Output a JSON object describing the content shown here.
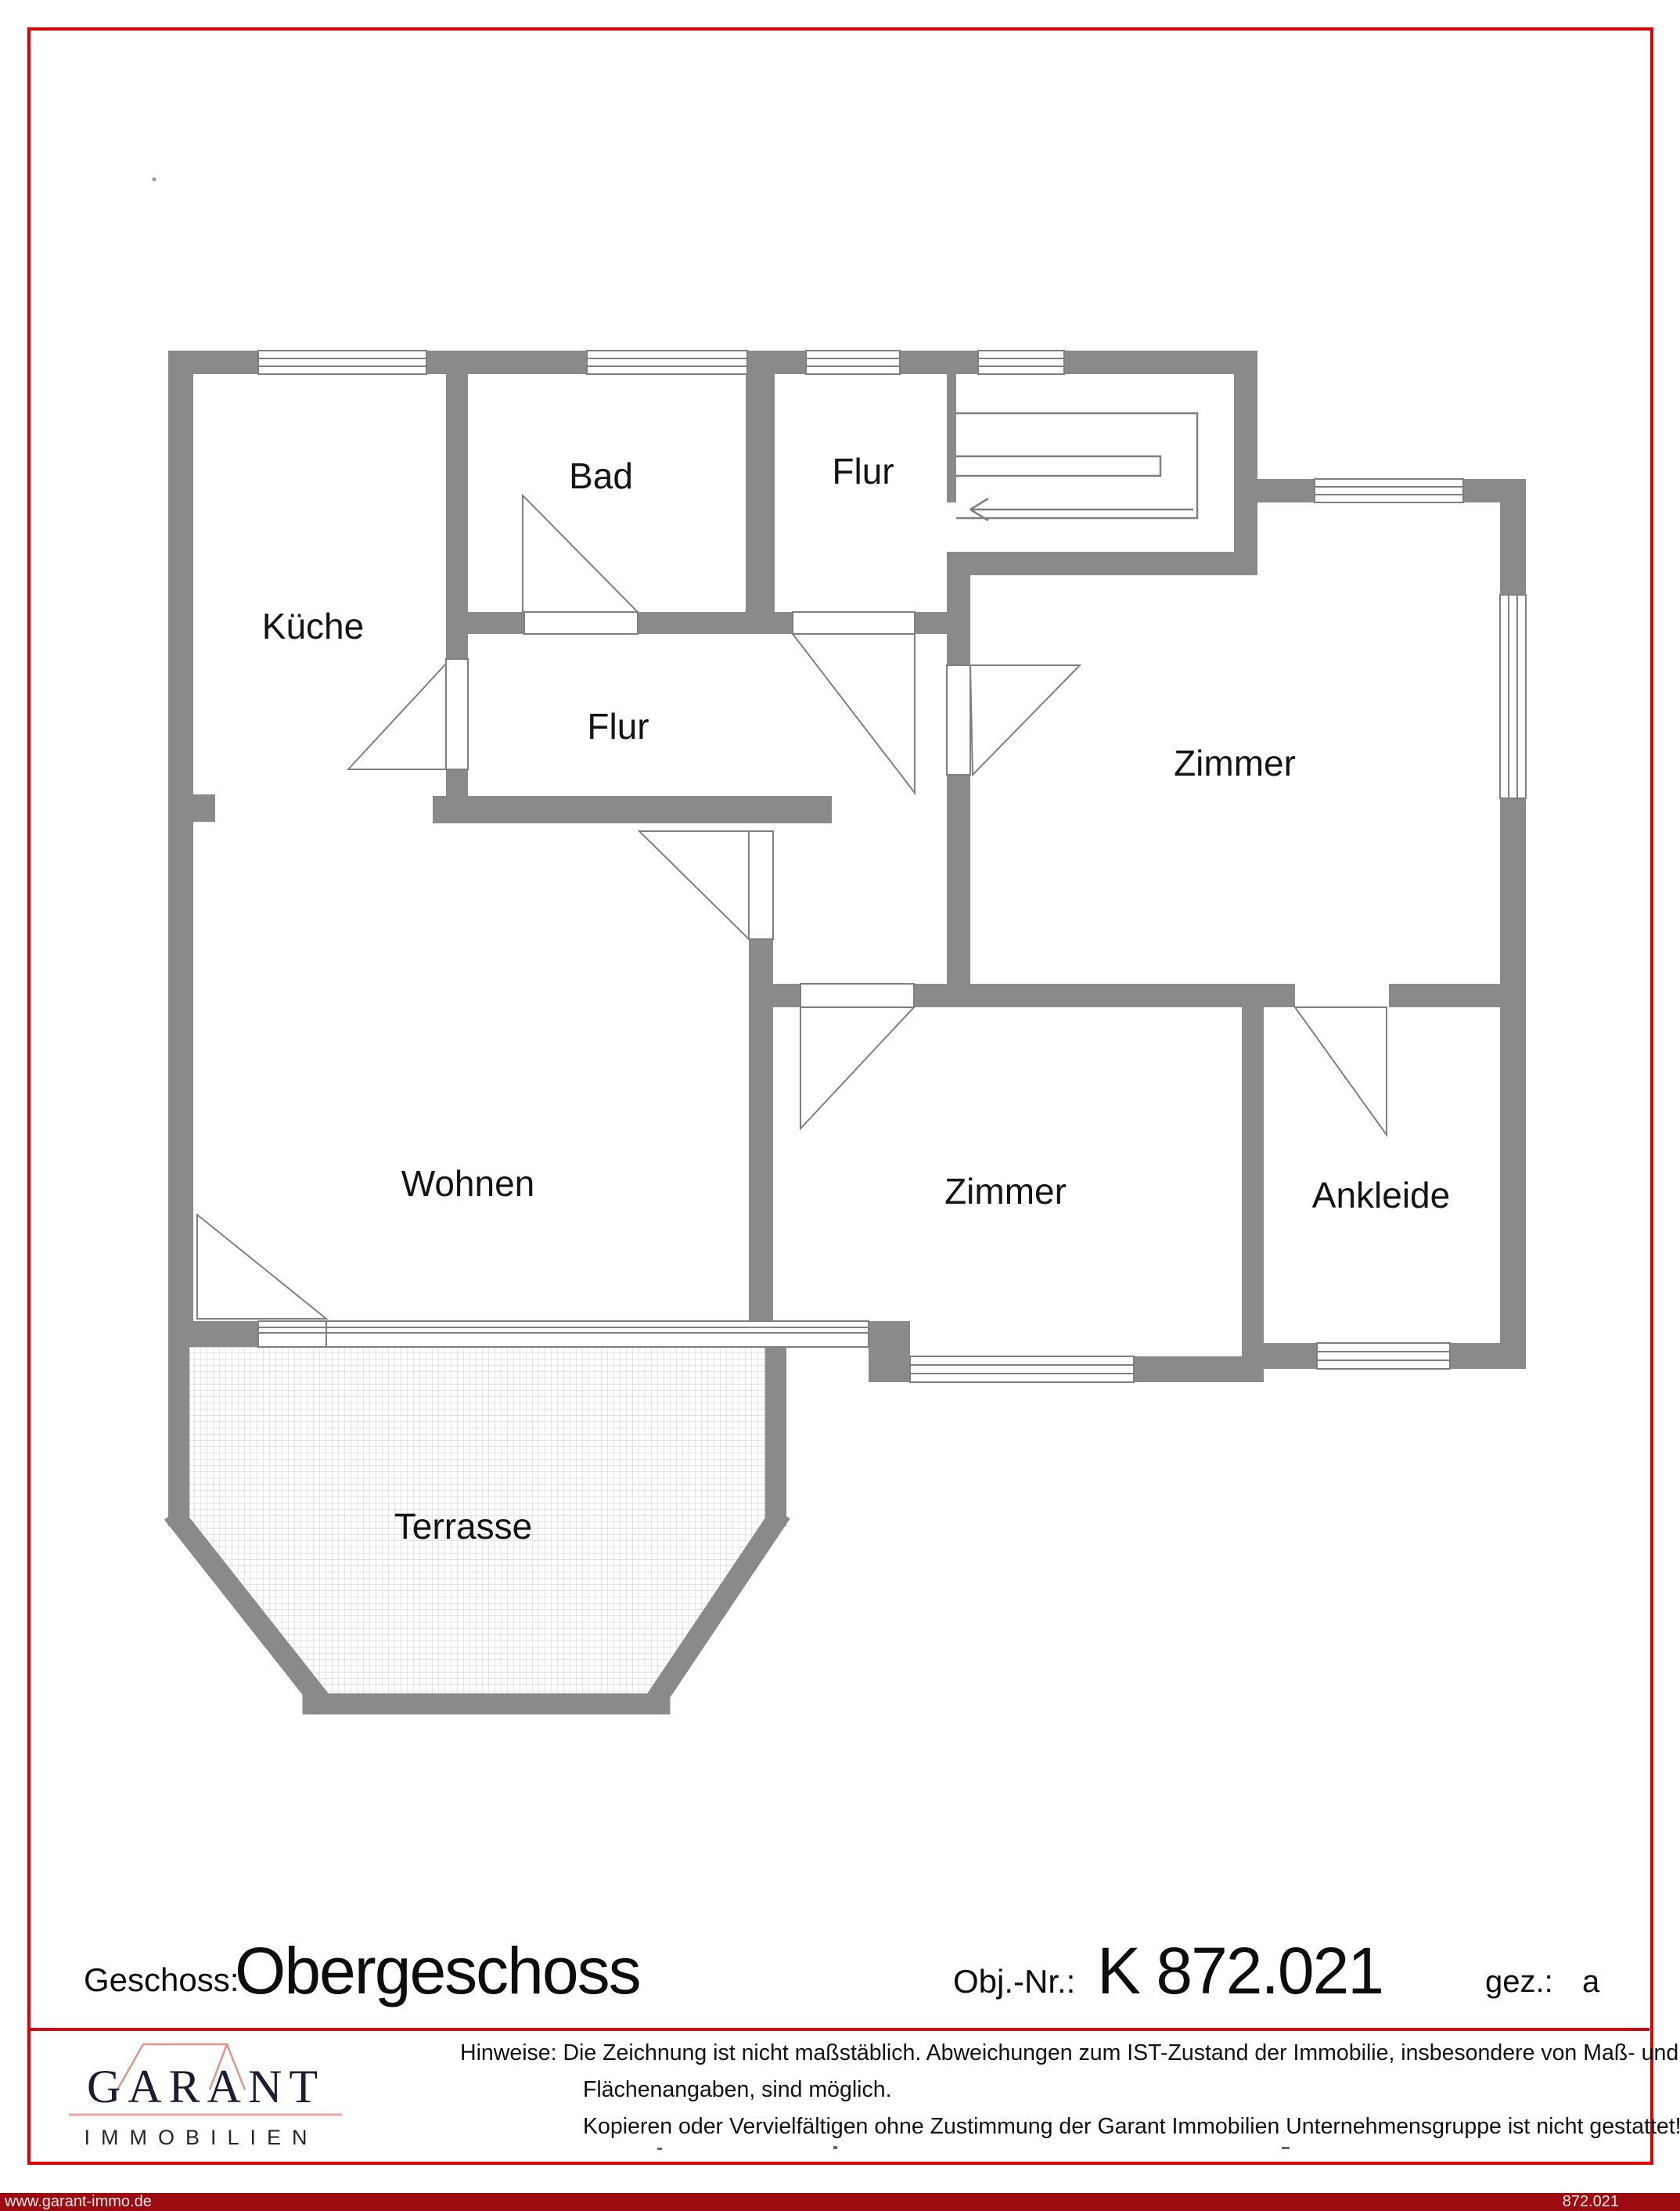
{
  "page": {
    "background": "#ffffff",
    "border_color": "#e60000",
    "separator_color": "#d10a10",
    "footer_bar_color": "#9c0b10"
  },
  "floorplan": {
    "wall_color": "#8a8a8a",
    "line_color": "#7f7f7f",
    "label_color": "#141414",
    "rooms": [
      {
        "id": "kueche",
        "label": "Küche"
      },
      {
        "id": "bad",
        "label": "Bad"
      },
      {
        "id": "flur-top",
        "label": "Flur"
      },
      {
        "id": "flur-mid",
        "label": "Flur"
      },
      {
        "id": "zimmer-right",
        "label": "Zimmer"
      },
      {
        "id": "wohnen",
        "label": "Wohnen"
      },
      {
        "id": "zimmer-bottom",
        "label": "Zimmer"
      },
      {
        "id": "ankleide",
        "label": "Ankleide"
      },
      {
        "id": "terrasse",
        "label": "Terrasse"
      }
    ]
  },
  "title_block": {
    "geschoss_label": "Geschoss:",
    "geschoss_value": "Obergeschoss",
    "obj_label": "Obj.-Nr.:",
    "obj_value": "K 872.021",
    "gez_label": "gez.:",
    "gez_value": "a"
  },
  "logo": {
    "name": "GARANT",
    "subtitle": "IMMOBILIEN",
    "roof_color": "#e8908c",
    "text_color": "#1d1c35"
  },
  "hinweise": {
    "label": "Hinweise:",
    "line1": "Die Zeichnung ist nicht maßstäblich. Abweichungen zum IST-Zustand der Immobilie, insbesondere von Maß- und",
    "line2": "Flächenangaben, sind möglich.",
    "line3": "Kopieren oder Vervielfältigen ohne Zustimmung der Garant Immobilien Unternehmensgruppe ist nicht gestattet!"
  },
  "footer": {
    "website": "www.garant-immo.de",
    "plan_number": "872.021"
  }
}
